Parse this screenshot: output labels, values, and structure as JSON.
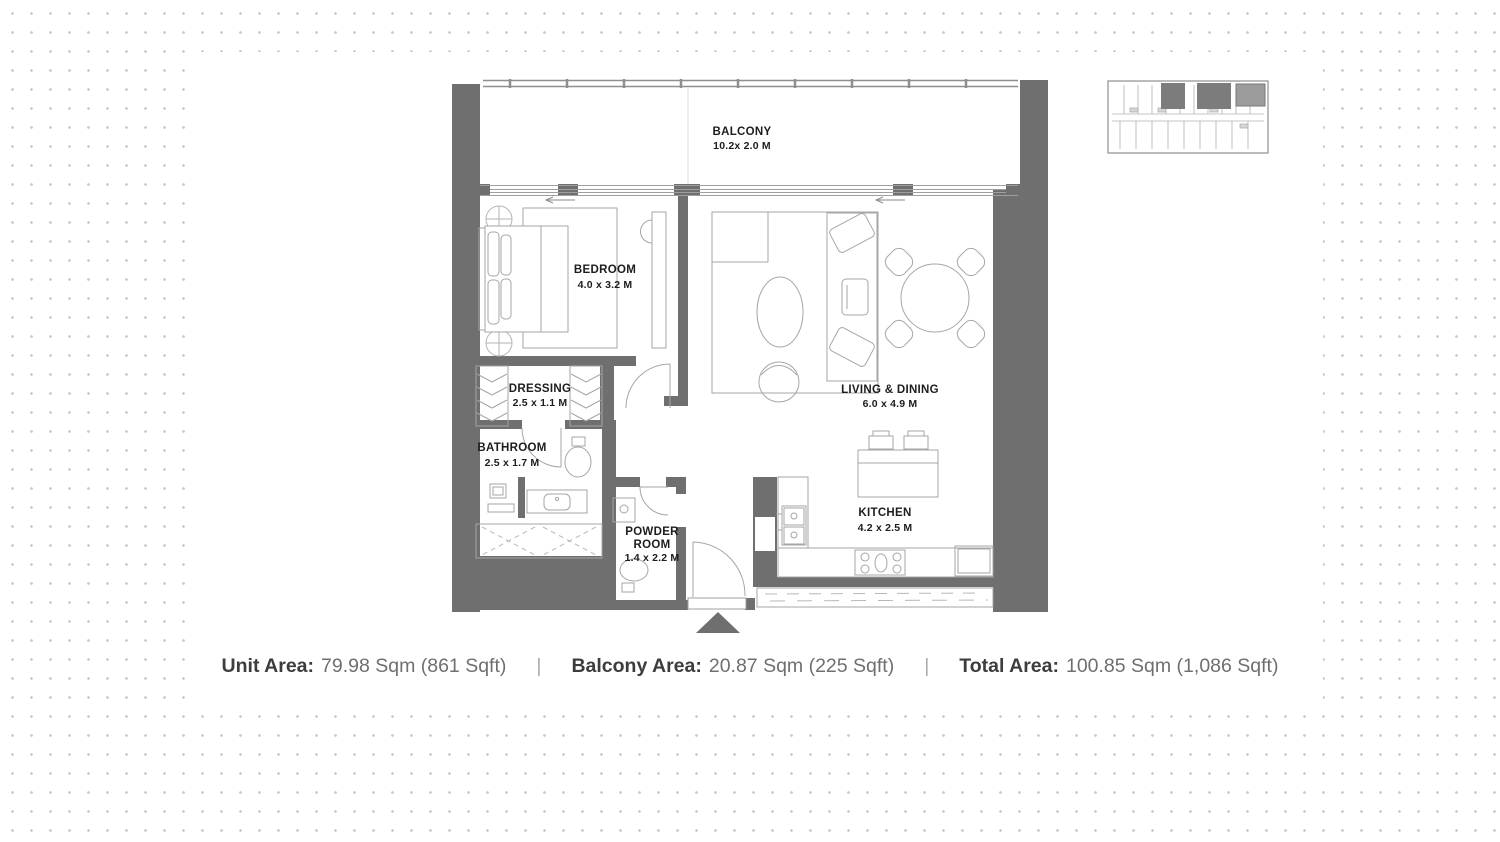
{
  "plan": {
    "balcony": {
      "name": "BALCONY",
      "dims": "10.2x 2.0 M"
    },
    "bedroom": {
      "name": "BEDROOM",
      "dims": "4.0 x 3.2 M"
    },
    "dressing": {
      "name": "DRESSING",
      "dims": "2.5 x 1.1 M"
    },
    "bathroom": {
      "name": "BATHROOM",
      "dims": "2.5 x 1.7 M"
    },
    "powder_room": {
      "line1": "POWDER",
      "line2": "ROOM",
      "dims": "1.4 x 2.2 M"
    },
    "living_dining": {
      "name": "LIVING & DINING",
      "dims": "6.0 x 4.9 M"
    },
    "kitchen": {
      "name": "KITCHEN",
      "dims": "4.2 x 2.5 M"
    }
  },
  "footer": {
    "unit_area_label": "Unit Area:",
    "unit_area_value": "79.98 Sqm (861 Sqft)",
    "separator": "|",
    "balcony_area_label": "Balcony Area:",
    "balcony_area_value": "20.87 Sqm (225 Sqft)",
    "total_area_label": "Total Area:",
    "total_area_value": "100.85 Sqm (1,086 Sqft)"
  },
  "colors": {
    "wall": "#6f6f6f",
    "furniture": "#a6a6a6",
    "window_line": "#9f9f9f",
    "hatch": "#b8b8b8",
    "label": "#1d1d1b",
    "dot": "#c7c7c7",
    "keyplan_core": "#7c7c7c",
    "keyplan_highlight": "#9c9c9c"
  }
}
